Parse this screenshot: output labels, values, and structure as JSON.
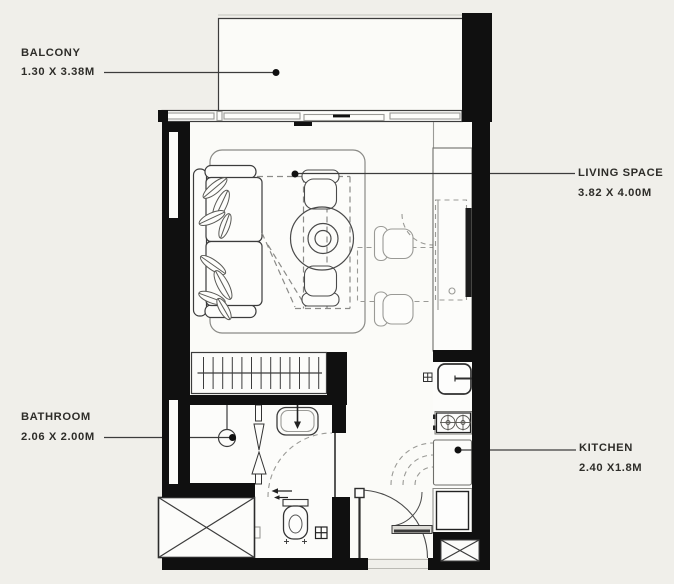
{
  "labels": {
    "balcony": {
      "title": "BALCONY",
      "dims": "1.30 X 3.38M"
    },
    "living_space": {
      "title": "LIVING SPACE",
      "dims": "3.82 X 4.00M"
    },
    "bathroom": {
      "title": "BATHROOM",
      "dims": "2.06 X 2.00M"
    },
    "kitchen": {
      "title": "KITCHEN",
      "dims": "2.40 X1.8M"
    }
  },
  "colors": {
    "background": "#f0efea",
    "floor": "#fbfbf8",
    "room": "#fdfdfb",
    "wall": "#101010",
    "line": "#3c3c3c",
    "light_line": "#9a9a96",
    "text": "#2e2d29"
  }
}
